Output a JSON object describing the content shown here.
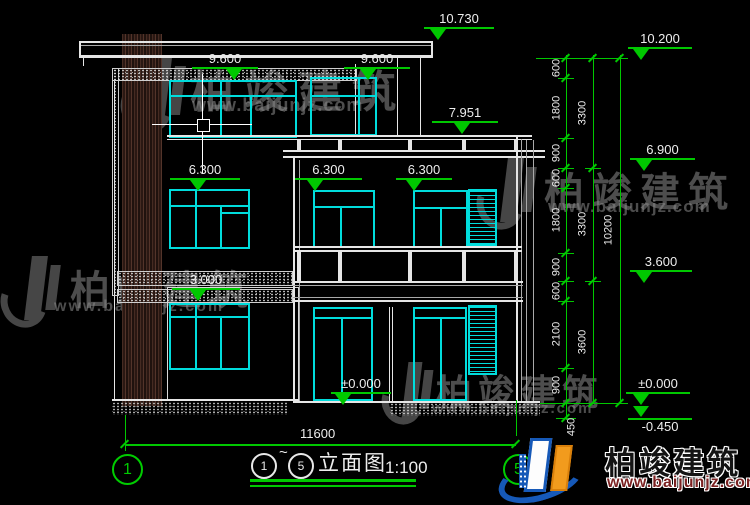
{
  "elevations": {
    "roof_peak": "10.730",
    "parapet_left": "9.600",
    "parapet_right": "9.600",
    "rail_top": "7.951",
    "floor2_left": "6.300",
    "floor2_mid": "6.300",
    "floor2_right": "6.300",
    "left_slab": "3.000",
    "ground_center": "±0.000",
    "right_top": "10.200",
    "right_upper_mid": "6.900",
    "right_lower_mid": "3.600",
    "right_ground": "±0.000",
    "right_below_grade": "-0.450"
  },
  "dimensions": {
    "inner": [
      "600",
      "1800",
      "900",
      "600",
      "1800",
      "900",
      "600",
      "2100",
      "900",
      "450"
    ],
    "middle": [
      "3300",
      "3300",
      "3600"
    ],
    "overall": "10200",
    "width": "11600"
  },
  "grid": {
    "start": "1",
    "end": "5"
  },
  "title": {
    "from": "1",
    "tilde": "~",
    "to": "5",
    "name": "立面图",
    "scale": "1:100"
  },
  "brand": {
    "name": "柏竣建筑",
    "url": "www.baijunjz.com"
  },
  "colors": {
    "line_green": "#00c800",
    "window_cyan": "#00dcdc",
    "brand_blue": "#1659b8",
    "brand_orange": "#f29b1d",
    "url_red": "#7c2222"
  }
}
